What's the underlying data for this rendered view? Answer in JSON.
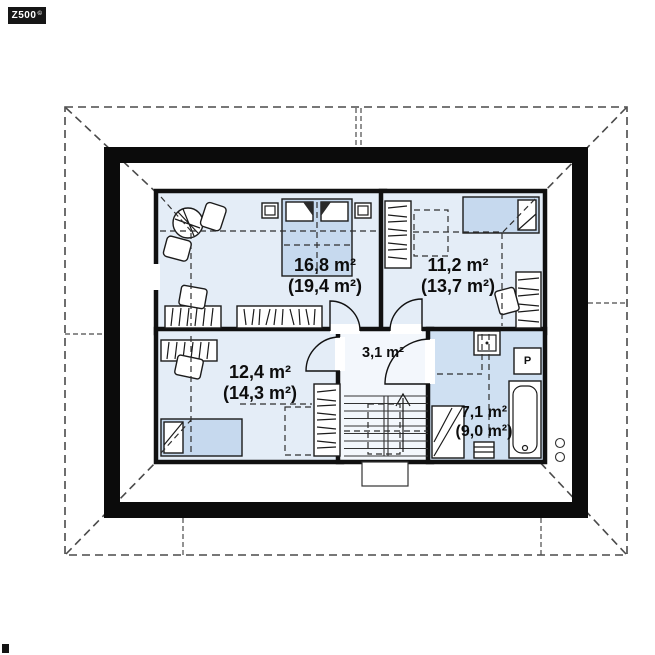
{
  "watermark": {
    "brand": "Z500",
    "symbol": "©"
  },
  "rooms": [
    {
      "id": "bedroom-main",
      "area_net": "16,8 m²",
      "area_gross": "(19,4 m²)"
    },
    {
      "id": "bedroom-right",
      "area_net": "11,2 m²",
      "area_gross": "(13,7 m²)"
    },
    {
      "id": "bedroom-left",
      "area_net": "12,4 m²",
      "area_gross": "(14,3 m²)"
    },
    {
      "id": "hallway",
      "area_net": "3,1 m²"
    },
    {
      "id": "bathroom",
      "area_net": "7,1 m²",
      "area_gross": "(9,0 m²)"
    }
  ],
  "appliances": {
    "washing_machine_label": "P"
  },
  "colors": {
    "wall": "#0b0b0b",
    "room_floor": "#e4edf7",
    "hall_floor": "#f3f7fc",
    "bathroom_floor": "#cfe0f2",
    "bed_fill": "#c6d9ee",
    "dashed_line": "#4a4a4a"
  }
}
